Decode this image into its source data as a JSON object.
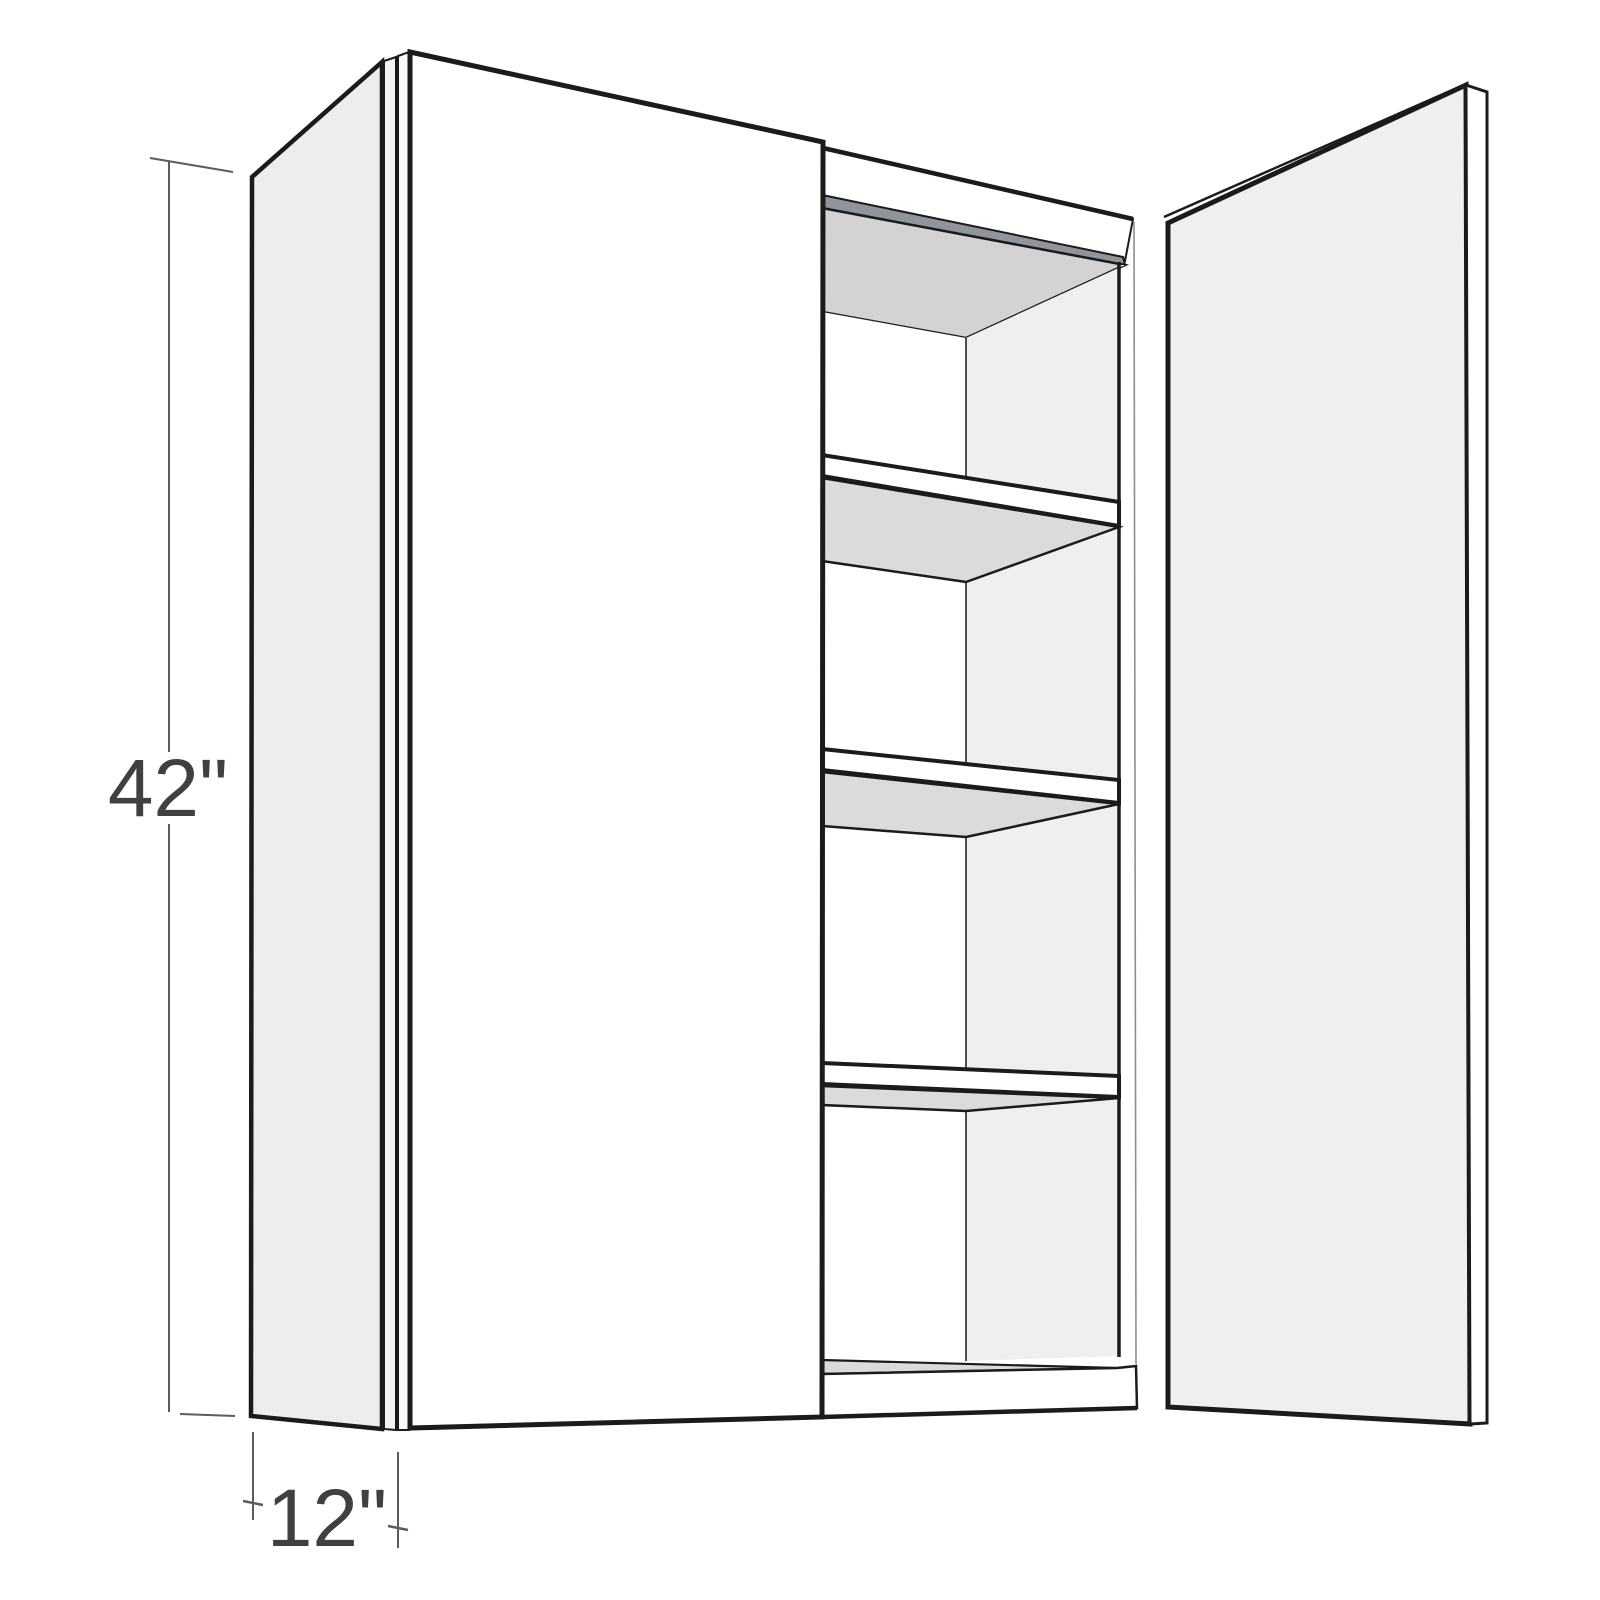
{
  "diagram": {
    "title": "wall-cabinet-dimension-diagram",
    "product": "Two-door wall cabinet shown with right door open and three interior shelves",
    "dimensions": {
      "height": {
        "label": "42\"",
        "value": 42,
        "unit": "in"
      },
      "depth": {
        "label": "12\"",
        "value": 12,
        "unit": "in"
      }
    },
    "colors": {
      "outline": "#1b1b1b",
      "door_front": "#ffffff",
      "panel_shaded": "#ededed",
      "interior_back": "#ffffff",
      "interior_ceiling": "#d3d3d3",
      "shelf_underside": "#dbdbdb",
      "top_edge_accent": "#8f959b",
      "dimension_lines": "#5c5c5c",
      "dimension_text": "#404040",
      "background": "#ffffff"
    }
  }
}
